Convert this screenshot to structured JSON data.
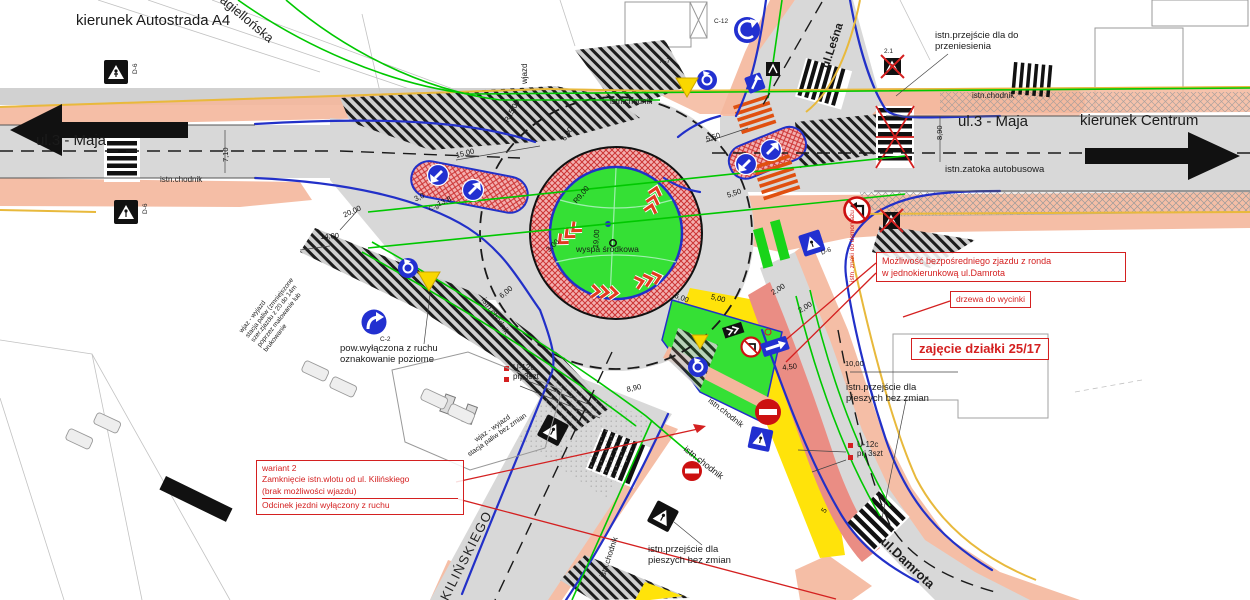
{
  "directions": {
    "west": "kierunek Autostrada A4",
    "east": "kierunek Centrum"
  },
  "streets": {
    "maja": "ul.3 - Maja",
    "lesna": "ul.Leśna",
    "jagiellonska": "Jagiellońska",
    "kilinskiego": "KILIŃSKIEGO",
    "damrota": "ul.Damrota",
    "wjazd": "wjazd"
  },
  "island": {
    "label": "wyspa środkowa"
  },
  "notes": {
    "wariant": {
      "l1": "wariant 2",
      "l2": "Zamknięcie istn.wlotu od ul. Kilińskiego",
      "l3": "(brak możliwości wjazdu)",
      "l4": "Odcinek jezdni wyłączony z ruchu"
    },
    "mozliwosc": {
      "l1": "Możliwość bezpośredniego zjazdu z ronda",
      "l2": "w jednokierunkową ul.Damrota"
    },
    "drzewa": "drzewa do wycinki",
    "zajecie": "zajęcie działki 25/17",
    "demontaz": "istn. znaki do demontażu"
  },
  "ann": {
    "chodnik": "istn.chodnik",
    "zatoka": "istn.zatoka autobusowa",
    "przen1": "istn.przejście dla do",
    "przen2": "przeniesienia",
    "bz1": "istn.przejście dla",
    "bz2": "pieszych bez zmian",
    "pow1": "pow.wyłączona z ruchu",
    "pow2": "oznakowanie poziome",
    "u12c": "U-12c",
    "prj": "prj  3szt",
    "st1": "wjaz - wyjazd",
    "st2": "stacja paliw bez zmian",
    "sd1": "wjaz - wyjazd",
    "sd2": "stacja paliw (zmniejszone",
    "sd3": "szer.zjazdu z 20 do 14m",
    "sd4": "poprzez malowanie lub",
    "sd5": "brukowanie"
  },
  "dims": [
    "7,10",
    "20,00",
    "14,00",
    "3,0",
    "13,8",
    "15,00",
    "R15,00",
    "6,00",
    "R9,00",
    "19,00",
    "3,00",
    "6,00",
    "6,00",
    "5,50",
    "5,50",
    "5,00",
    "4,50",
    "2,00",
    "2,00",
    "10,00",
    "8,90",
    "8,90",
    "5"
  ],
  "codes": {
    "d6": "D-6",
    "c9": "C-9",
    "c12": "C-12",
    "a7": "A-7",
    "c2": "C-2",
    "x21": "2.1"
  },
  "colors": {
    "road": "#d8d8d8",
    "sidewalk": "#f4b79c",
    "island_green": "#35e035",
    "apron_pink": "#f3b0b0",
    "apron_red": "#cc3333",
    "curb_blue": "#2230c8",
    "exclusion_yellow": "#ffe30a",
    "median_red": "#ea8d84",
    "note_red": "#d42020",
    "utility_green": "#00c800",
    "curb_orange": "#e8b93c",
    "sign_blue": "#2230d0",
    "prohibit_red": "#cc1111"
  }
}
